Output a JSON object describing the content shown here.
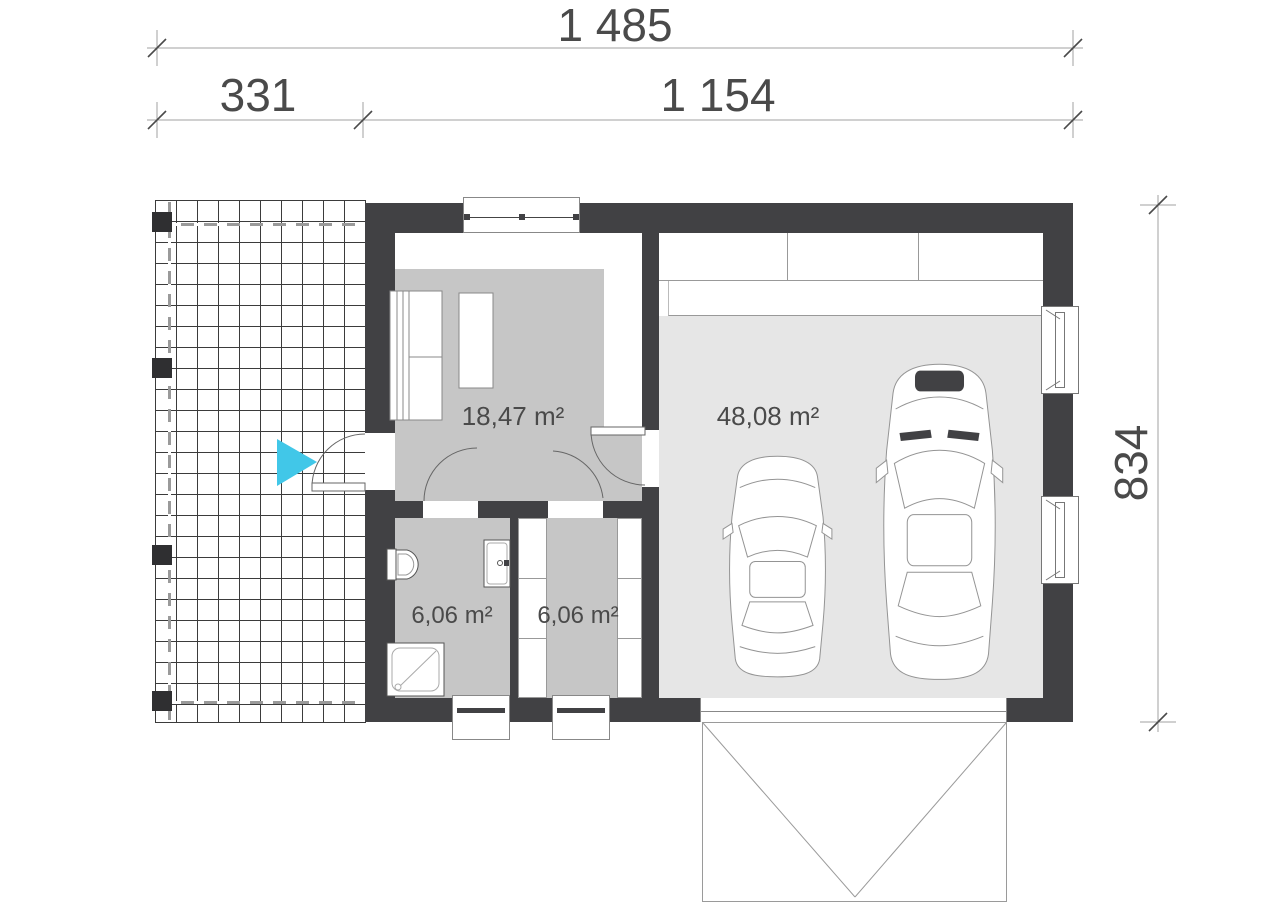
{
  "dimensions": {
    "total_width": "1 485",
    "terrace_width": "331",
    "house_width": "1 154",
    "house_depth": "834"
  },
  "rooms": {
    "living": {
      "area": "18,47 m²"
    },
    "garage": {
      "area": "48,08 m²"
    },
    "bathroom": {
      "area": "6,06 m²"
    },
    "wardrobe": {
      "area": "6,06 m²"
    }
  },
  "icons": {
    "entrance_arrow": "right-pointing-triangle"
  },
  "colors": {
    "wall": "#414144",
    "room_floor": "#c6c6c6",
    "garage_floor": "#e6e6e6",
    "accent_cyan": "#41c7e8",
    "dimension_text": "#4a4a4a",
    "line": "#9a9a9a"
  }
}
